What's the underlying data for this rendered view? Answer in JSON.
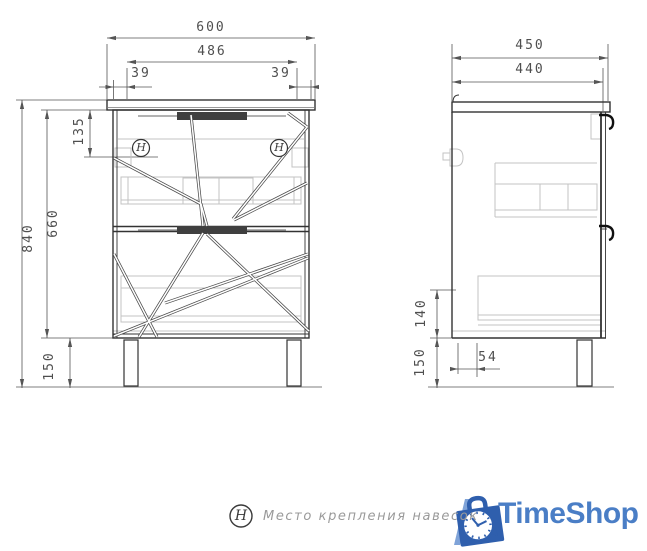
{
  "colors": {
    "main_line": "#333333",
    "hidden_line": "#c3c3c3",
    "dimension": "#4f4f4f",
    "legend_text": "#9a9a9a",
    "logo_blue": "#4a7ec6",
    "logo_bag": "#2f5fad",
    "logo_slash": "#7fa3d8"
  },
  "front_view": {
    "dimensions": {
      "overall_width": "600",
      "inner_width": "486",
      "left_offset": "39",
      "right_offset": "39",
      "overall_height": "840",
      "cabinet_height": "660",
      "mount_offset": "135",
      "leg_height": "150"
    },
    "mount_left_symbol": "H",
    "mount_right_symbol": "H"
  },
  "side_view": {
    "dimensions": {
      "overall_depth": "450",
      "inner_depth": "440",
      "bottom_section": "140",
      "leg_height": "150",
      "leg_inset": "54"
    }
  },
  "legend": {
    "symbol": "H",
    "text": "Место крепления навесок"
  },
  "logo": {
    "text": "TimeShop"
  }
}
